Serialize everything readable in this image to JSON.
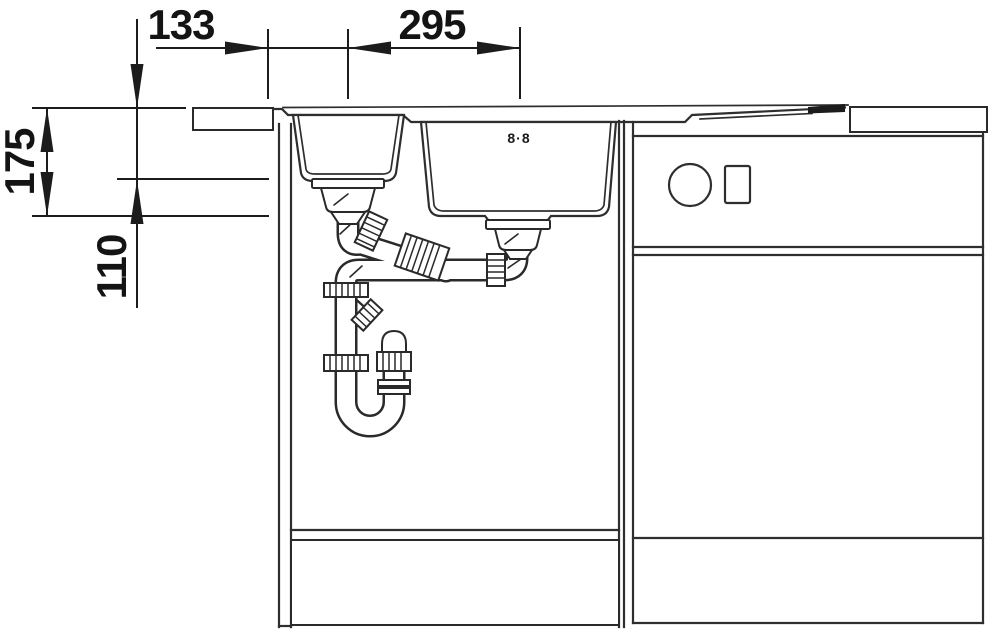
{
  "drawing": {
    "background": "#ffffff",
    "line_color": "#2e2e2e",
    "text_color": "#141414"
  },
  "dimension_labels": {
    "edge_to_small_drain": "133",
    "drain_to_drain": "295",
    "main_bowl_depth": "175",
    "small_bowl_depth": "110"
  },
  "sink": {
    "brand_mark": "8·8"
  }
}
